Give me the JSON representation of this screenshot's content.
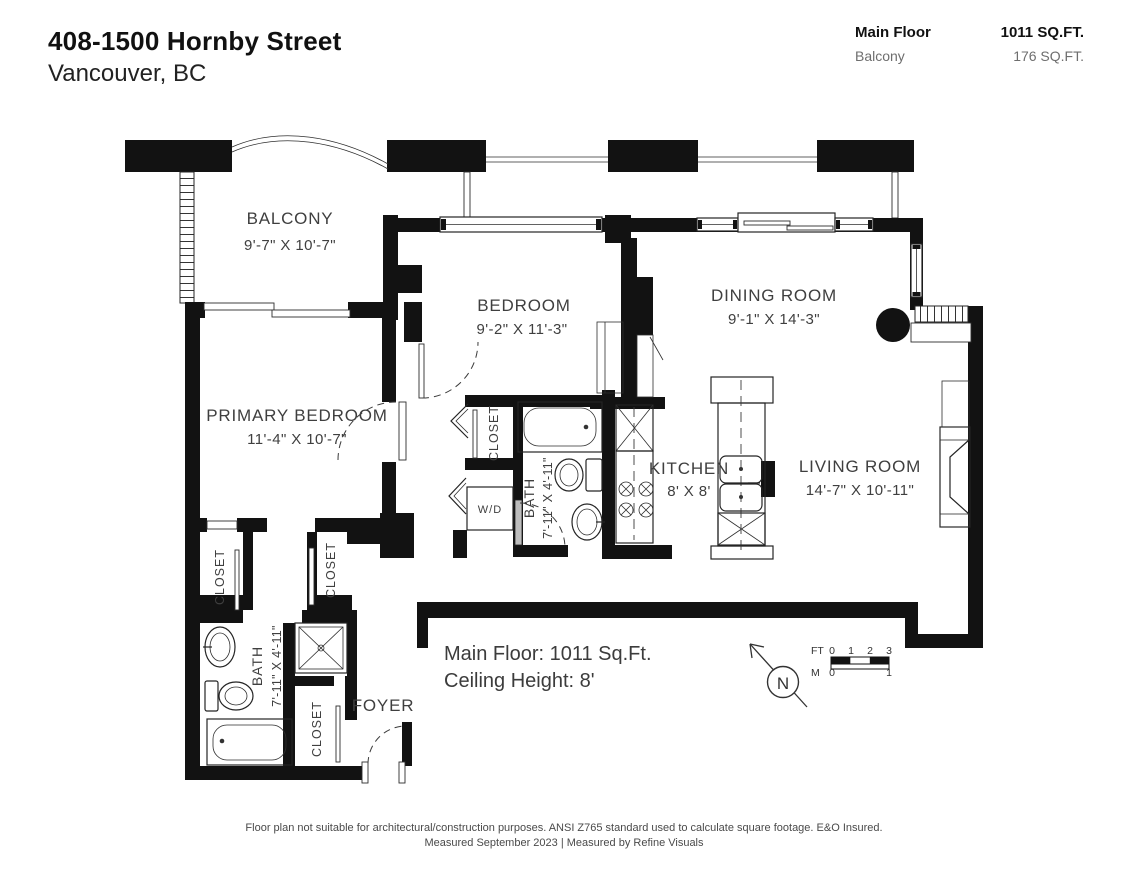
{
  "header": {
    "address": "408-1500 Hornby Street",
    "city": "Vancouver, BC",
    "areas": [
      {
        "label": "Main Floor",
        "value": "1011 SQ.FT."
      },
      {
        "label": "Balcony",
        "value": "176 SQ.FT."
      }
    ]
  },
  "rooms": {
    "balcony": {
      "name": "BALCONY",
      "dims": "9'-7\" X 10'-7\""
    },
    "bedroom": {
      "name": "BEDROOM",
      "dims": "9'-2\" X 11'-3\""
    },
    "dining": {
      "name": "DINING ROOM",
      "dims": "9'-1\" X 14'-3\""
    },
    "primary": {
      "name": "PRIMARY BEDROOM",
      "dims": "11'-4\" X 10'-7\""
    },
    "kitchen": {
      "name": "KITCHEN",
      "dims": "8' X 8'"
    },
    "living": {
      "name": "LIVING ROOM",
      "dims": "14'-7\" X 10'-11\""
    },
    "bath": {
      "name": "BATH",
      "dims": "7'-11\" X 4'-11\""
    },
    "foyer": {
      "name": "FOYER"
    },
    "closet_label": "CLOSET",
    "wd_label": "W/D"
  },
  "annotations": {
    "floor_area": "Main Floor: 1011 Sq.Ft.",
    "ceiling": "Ceiling Height: 8'",
    "north_letter": "N",
    "scale": {
      "ft_label": "FT",
      "ft_ticks": [
        "0",
        "1",
        "2",
        "3"
      ],
      "m_label": "M",
      "m_ticks": [
        "0",
        "1"
      ]
    }
  },
  "footer": {
    "line1": "Floor plan not suitable for architectural/construction purposes. ANSI Z765 standard used to calculate square footage. E&O Insured.",
    "line2": "Measured September 2023 | Measured by Refine Visuals"
  },
  "colors": {
    "wall": "#121212",
    "line": "#242424",
    "label_text": "#3f3f3f",
    "muted_text": "#6e6e6e",
    "background": "#ffffff"
  }
}
